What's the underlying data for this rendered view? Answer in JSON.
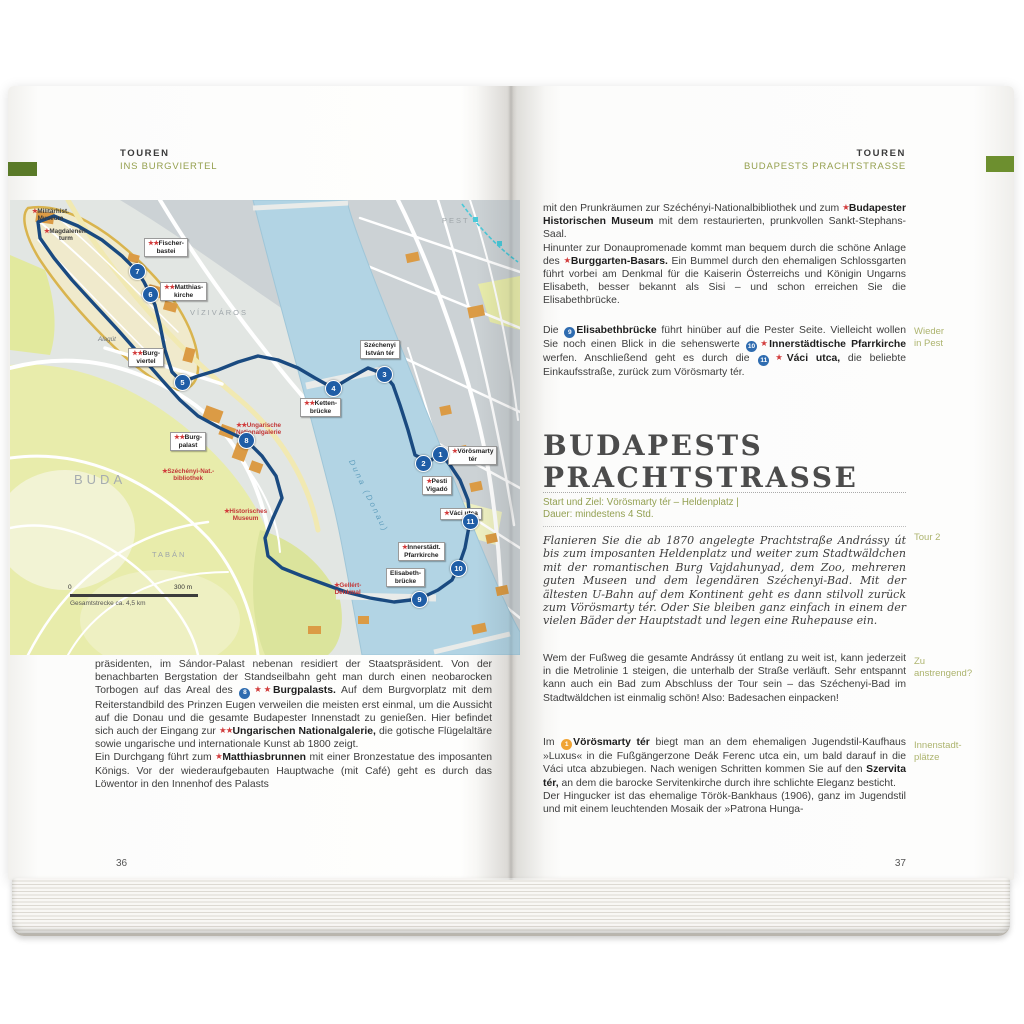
{
  "colors": {
    "accent_green": "#6d8f2f",
    "header_green": "#95a04f",
    "star_red": "#d23c3c",
    "route_blue": "#1a4a80",
    "stop_blue": "#1f5da6",
    "badge_orange": "#f0a435",
    "river_blue": "#b2d4e4"
  },
  "left_page": {
    "kicker": "TOUREN",
    "subtitle": "INS BURGVIERTEL",
    "page_number": "36",
    "p1": {
      "r0": "präsidenten, im Sándor-Palast nebenan residiert der Staatspräsident. Von der benachbarten Bergstation der Standseilbahn geht man durch einen neobarocken Torbogen auf das Areal des ",
      "badge": "8",
      "stars": "★★",
      "b1": "Burgpalasts.",
      "r1": " Auf dem Burgvorplatz mit dem Reiterstandbild des Prinzen Eugen verweilen die meisten erst einmal, um die Aussicht auf die Donau und die gesamte Budapester Innenstadt zu genießen. Hier befindet sich auch der Eingang zur ",
      "stars2": "★★",
      "b2": "Ungarischen Nationalgalerie,",
      "r2": " die gotische Flügelaltäre sowie ungarische und internationale Kunst ab 1800 zeigt."
    },
    "p2": {
      "r0": "Ein Durchgang führt zum ",
      "stars": "★",
      "b1": "Matthiasbrunnen",
      "r1": " mit einer Bronzestatue des imposanten Königs. Vor der wiederaufgebauten Hauptwache (mit Café) geht es durch das Löwentor in den Innenhof des Palasts"
    }
  },
  "right_page": {
    "kicker": "TOUREN",
    "subtitle": "BUDAPESTS PRACHTSTRASSE",
    "page_number": "37",
    "p1": {
      "r0": "mit den Prunkräumen zur Széchényi-Nationalbibliothek und zum ",
      "stars": "★",
      "b1": "Budapester Historischen Museum",
      "r1": " mit dem restaurierten, prunkvollen Sankt-Stephans-Saal."
    },
    "p2": {
      "r0": "Hinunter zur Donaupromenade kommt man bequem durch die schöne Anlage des ",
      "stars": "★",
      "b1": "Burggarten-Basars.",
      "r1": " Ein Bummel durch den ehemaligen Schlossgarten führt vorbei am Denkmal für die Kaiserin Österreichs und Königin Ungarns Elisabeth, besser bekannt als Sisi – und schon erreichen Sie die Elisabethbrücke."
    },
    "p3": {
      "r0": "Die ",
      "badge1": "9",
      "b1": "Elisabethbrücke",
      "r1": " führt hinüber auf die Pester Seite. Vielleicht wollen Sie noch einen Blick in die sehenswerte ",
      "badge2": "10",
      "stars2": "★",
      "b2": "Innerstädtische Pfarrkirche",
      "r2": " werfen. Anschließend geht es durch die ",
      "badge3": "11",
      "stars3": "★",
      "b3": "Váci utca,",
      "r3": " die beliebte Einkaufsstraße, zurück zum Vörösmarty tér."
    },
    "section": {
      "line1": "BUDAPESTS",
      "line2": "PRACHTSTRASSE",
      "info1": "Start und Ziel: Vörösmarty tér – Heldenplatz |",
      "info2": "Dauer: mindestens 4 Std."
    },
    "p4": "Flanieren Sie die ab 1870 angelegte Prachtstraße Andrássy út bis zum imposanten Heldenplatz und weiter zum Stadtwäldchen mit der romantischen Burg Vajdahunyad, dem Zoo, mehreren guten Museen und dem legendären Széchenyi-Bad. Mit der ältesten U-Bahn auf dem Kontinent geht es dann stilvoll zurück zum Vörösmarty tér. Oder Sie bleiben ganz einfach in einem der vielen Bäder der Hauptstadt und legen eine Ruhepause ein.",
    "p5": "Wem der Fußweg die gesamte Andrássy út entlang zu weit ist, kann jederzeit in die Metrolinie 1 steigen, die unterhalb der Straße verläuft. Sehr entspannt kann auch ein Bad zum Abschluss der Tour sein – das Széchenyi-Bad im Stadtwäldchen ist einmalig schön! Also: Badesachen einpacken!",
    "p6": {
      "r0": "Im ",
      "badge": "1",
      "b1": "Vörösmarty tér",
      "r1": " biegt man an dem ehemaligen Jugendstil-Kaufhaus »Luxus« in die Fußgängerzone Deák Ferenc utca ein, um bald darauf in die Váci utca abzubiegen. Nach wenigen Schritten kommen Sie auf den ",
      "b2": "Szervita tér,",
      "r2": " an dem die barocke Servitenkirche durch ihre schlichte Eleganz besticht."
    },
    "p7": "Der Hingucker ist das ehemalige Török-Bankhaus (1906), ganz im Jugendstil und mit einem leuchtenden Mosaik der »Patrona Hunga-",
    "margin_notes": [
      {
        "l1": "Wieder",
        "l2": "in Pest"
      },
      {
        "l1": "Tour 2",
        "l2": ""
      },
      {
        "l1": "Zu",
        "l2": "anstrengend?"
      },
      {
        "l1": "Innenstadt-",
        "l2": "plätze"
      }
    ]
  },
  "map": {
    "stops": [
      "1",
      "2",
      "3",
      "4",
      "5",
      "6",
      "7",
      "8",
      "9",
      "10",
      "11"
    ],
    "boxes": [
      {
        "stars": "★★",
        "l1": "Fischer-",
        "l2": "bastei"
      },
      {
        "stars": "★★",
        "l1": "Matthias-",
        "l2": "kirche"
      },
      {
        "stars": "★★",
        "l1": "Burg-",
        "l2": "viertel"
      },
      {
        "stars": "★★",
        "l1": "Burg-",
        "l2": "palast"
      },
      {
        "stars": "★★",
        "l1": "Ketten-",
        "l2": "brücke"
      },
      {
        "stars": "",
        "l1": "Széchenyi",
        "l2": "István tér"
      },
      {
        "stars": "★",
        "l1": "Vörösmarty",
        "l2": "tér"
      },
      {
        "stars": "★",
        "l1": "Pesti",
        "l2": "Vigadó"
      },
      {
        "stars": "★",
        "l1": "Váci utca",
        "l2": ""
      },
      {
        "stars": "★",
        "l1": "Innerstädt.",
        "l2": "Pfarrkirche"
      },
      {
        "stars": "",
        "l1": "Elisabeth-",
        "l2": "brücke"
      }
    ],
    "texts": [
      {
        "stars": "★",
        "l1": "Militärhist.",
        "l2": "Museum"
      },
      {
        "stars": "★",
        "l1": "Magdalenen-",
        "l2": "turm"
      },
      {
        "stars": "★★",
        "l1": "Ungarische",
        "l2": "Nationalgalerie"
      },
      {
        "stars": "★",
        "l1": "Széchényi-Nat.-",
        "l2": "bibliothek"
      },
      {
        "stars": "★",
        "l1": "Historisches",
        "l2": "Museum"
      },
      {
        "stars": "",
        "l1": "Alagút",
        "l2": ""
      },
      {
        "stars": "★",
        "l1": "Gellért-",
        "l2": "Denkmal"
      }
    ],
    "districts": [
      "BUDA",
      "VÍZIVÁROS",
      "TABÁN",
      "PEST"
    ],
    "river": "Duna (Donau)",
    "scale": {
      "zero": "0",
      "end": "300 m",
      "note": "Gesamtstrecke ca. 4,5 km"
    }
  }
}
